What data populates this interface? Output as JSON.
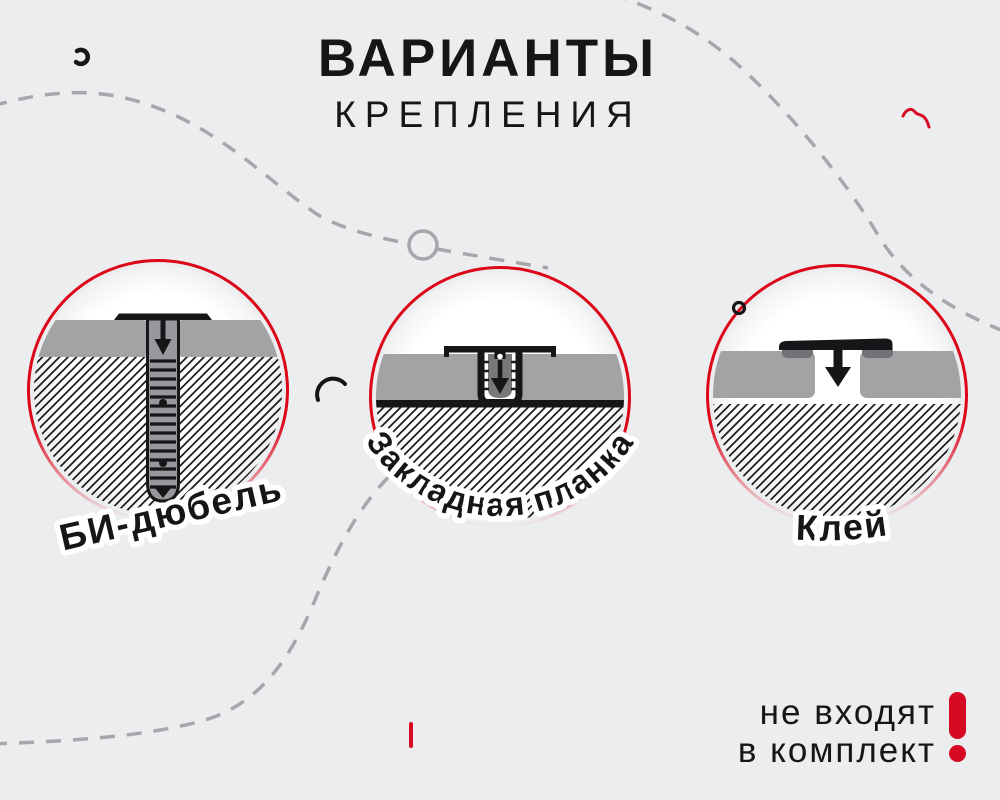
{
  "title": {
    "line1": "ВАРИАНТЫ",
    "line2": "КРЕПЛЕНИЯ"
  },
  "options": [
    {
      "label": "БИ-дюбель"
    },
    {
      "label": "Закладная планка"
    },
    {
      "label": "Клей"
    }
  ],
  "note": {
    "line1": "не входят",
    "line2": "в комплект",
    "mark": "!"
  },
  "colors": {
    "background": "#ECEDEF",
    "accent_red": "#D60A22",
    "ring_red": "#DC0619",
    "panel_gray": "#A2A3A5",
    "glue_gray": "#717276",
    "dash_gray": "#A5A7AA",
    "text_dark": "#161618"
  }
}
